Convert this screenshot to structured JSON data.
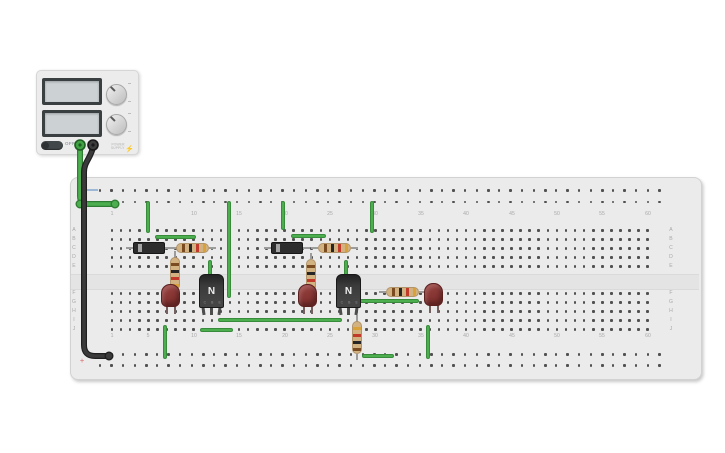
{
  "psu": {
    "off_label": "OFF",
    "brand_line1": "POWER",
    "brand_line2": "SUPPLY",
    "bolt_icon": "⚡"
  },
  "breadboard": {
    "column_count": 60,
    "column_labels": [
      1,
      5,
      10,
      15,
      20,
      25,
      30,
      35,
      40,
      45,
      50,
      55,
      60
    ],
    "row_labels_top": [
      "A",
      "B",
      "C",
      "D",
      "E"
    ],
    "row_labels_bottom": [
      "F",
      "G",
      "H",
      "I",
      "J"
    ],
    "minus_mark_color": "#9db8d6",
    "plus_symbol": "+",
    "plus_mark_color": "#dd8c8c"
  },
  "colors": {
    "wire_green": "#4cae4f",
    "wire_green_border": "#388b3b",
    "wire_black": "#3a3a3a",
    "resistor_body": "#d2b281",
    "band_brown": "#7a4a21",
    "band_black": "#262626",
    "band_red": "#c23b2a",
    "band_gold": "#d8a13a",
    "led_red": "#8e3a3a",
    "transistor_dark": "#383838"
  },
  "circuit": {
    "supply_wires": [
      {
        "name": "psu-positive-wire",
        "color": "#4cae4f",
        "border": "#2f7d32",
        "path": "M 80 147 L 80 196 Q 80 204 88 204 L 115 204",
        "dots": [
          [
            80,
            204
          ],
          [
            115,
            204
          ]
        ]
      },
      {
        "name": "psu-negative-wire",
        "color": "#3a3a3a",
        "border": "#1f1f1f",
        "path": "M 93 147 C 91 158 84 162 84 172 L 84 345 Q 84 356 95 356 L 109 356",
        "dots": [
          [
            109,
            356
          ]
        ]
      }
    ],
    "terminals": [
      {
        "name": "psu-terminal-positive",
        "x": 80,
        "y": 145,
        "fill": "#3fa344",
        "ring": "#1e5e22"
      },
      {
        "name": "psu-terminal-negative",
        "x": 93,
        "y": 145,
        "fill": "#3c3c3c",
        "ring": "#181818"
      }
    ],
    "wires": [
      {
        "name": "wire-plusrail-a5",
        "x1": 148,
        "y1": 203,
        "x2": 148,
        "y2": 231
      },
      {
        "name": "wire-plusrail-f14",
        "x1": 229,
        "y1": 203,
        "x2": 229,
        "y2": 296
      },
      {
        "name": "wire-row-b-stage1",
        "x1": 157,
        "y1": 237,
        "x2": 194,
        "y2": 237
      },
      {
        "name": "wire-base-stage1",
        "x1": 210,
        "y1": 262,
        "x2": 210,
        "y2": 279
      },
      {
        "name": "wire-row-j",
        "x1": 202,
        "y1": 330,
        "x2": 231,
        "y2": 330
      },
      {
        "name": "wire-col7-ground",
        "x1": 165,
        "y1": 327,
        "x2": 165,
        "y2": 357
      },
      {
        "name": "wire-plusrail-a20",
        "x1": 283,
        "y1": 203,
        "x2": 283,
        "y2": 228
      },
      {
        "name": "wire-plusrail-a29",
        "x1": 372,
        "y1": 203,
        "x2": 372,
        "y2": 231
      },
      {
        "name": "wire-row-b-stage2",
        "x1": 293,
        "y1": 236,
        "x2": 324,
        "y2": 236
      },
      {
        "name": "wire-base-stage2",
        "x1": 346,
        "y1": 262,
        "x2": 346,
        "y2": 279
      },
      {
        "name": "wire-row-i",
        "x1": 220,
        "y1": 320,
        "x2": 340,
        "y2": 320
      },
      {
        "name": "wire-row-g",
        "x1": 352,
        "y1": 301,
        "x2": 417,
        "y2": 301
      },
      {
        "name": "wire-bottom-rail",
        "x1": 364,
        "y1": 356,
        "x2": 392,
        "y2": 356
      },
      {
        "name": "wire-col36-ground",
        "x1": 428,
        "y1": 327,
        "x2": 428,
        "y2": 357
      }
    ],
    "components": [
      {
        "type": "diode",
        "name": "diode-1",
        "x": 133,
        "y": 242
      },
      {
        "type": "diode",
        "name": "diode-2",
        "x": 271,
        "y": 242
      },
      {
        "type": "resistor",
        "name": "resistor-1",
        "orient": "h",
        "x": 176,
        "y": 243,
        "bands": [
          "brown",
          "black",
          "red",
          "gold"
        ]
      },
      {
        "type": "resistor",
        "name": "resistor-2",
        "orient": "v",
        "x": 170,
        "y": 257,
        "bands": [
          "brown",
          "black",
          "red",
          "gold"
        ]
      },
      {
        "type": "resistor",
        "name": "resistor-3",
        "orient": "h",
        "x": 318,
        "y": 243,
        "bands": [
          "brown",
          "black",
          "red",
          "gold"
        ]
      },
      {
        "type": "resistor",
        "name": "resistor-4",
        "orient": "v",
        "x": 306,
        "y": 259,
        "bands": [
          "brown",
          "black",
          "red",
          "gold"
        ]
      },
      {
        "type": "resistor",
        "name": "resistor-5",
        "orient": "v",
        "x": 352,
        "y": 321,
        "bands": [
          "gold",
          "red",
          "black",
          "brown"
        ]
      },
      {
        "type": "resistor",
        "name": "resistor-6",
        "orient": "h",
        "x": 386,
        "y": 287,
        "bands": [
          "brown",
          "black",
          "red",
          "gold"
        ]
      },
      {
        "type": "led",
        "name": "led-1",
        "x": 161,
        "y": 284
      },
      {
        "type": "led",
        "name": "led-2",
        "x": 298,
        "y": 284
      },
      {
        "type": "led",
        "name": "led-3",
        "x": 424,
        "y": 283
      },
      {
        "type": "transistor",
        "name": "transistor-1",
        "x": 199,
        "y": 274,
        "label": "N",
        "pins": "C B E"
      },
      {
        "type": "transistor",
        "name": "transistor-2",
        "x": 336,
        "y": 274,
        "label": "N",
        "pins": "C B E"
      }
    ]
  }
}
